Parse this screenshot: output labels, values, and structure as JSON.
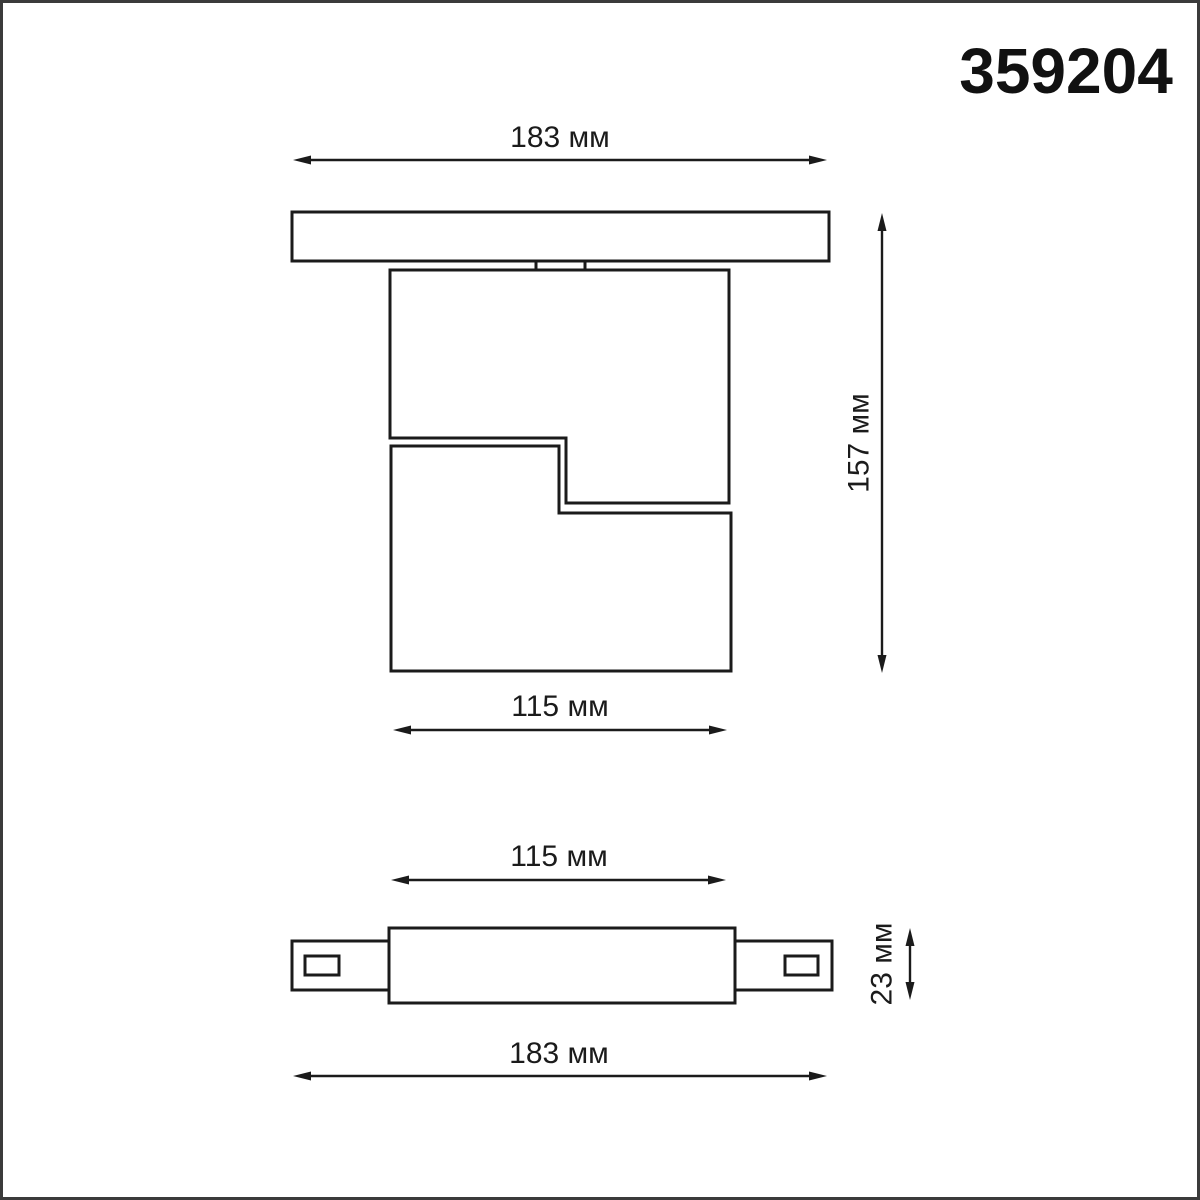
{
  "page": {
    "background": "#ffffff",
    "frame_color": "#3b3b3b"
  },
  "product": {
    "article": "359204"
  },
  "drawing": {
    "line_color": "#1b1b1b",
    "unit": "мм",
    "front_view": {
      "dim_track_length": "183 мм",
      "dim_total_height": "157 мм",
      "dim_body_width": "115 мм"
    },
    "side_view": {
      "dim_body_width": "115 мм",
      "dim_track_height": "23 мм",
      "dim_track_length": "183 мм"
    }
  }
}
